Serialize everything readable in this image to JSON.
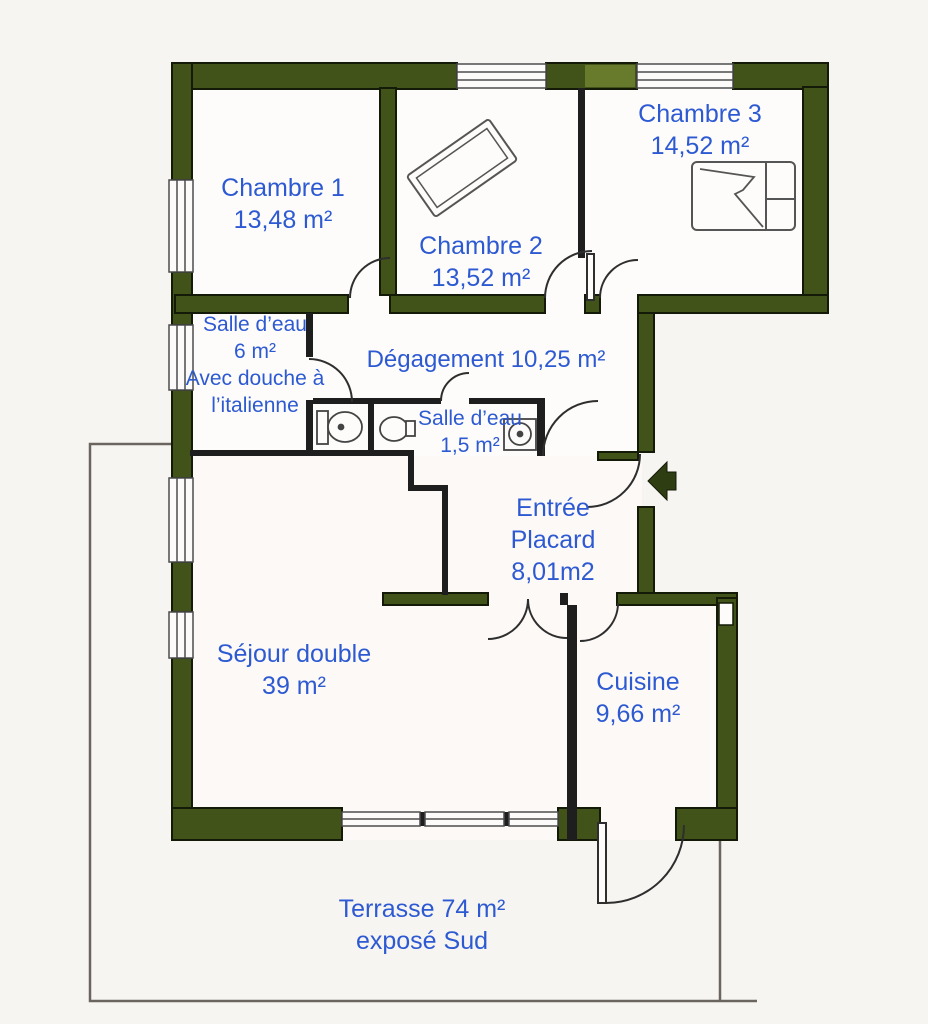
{
  "document": {
    "type": "apartment-floor-plan",
    "language": "fr"
  },
  "colors": {
    "label_blue": "#2d5ad2",
    "wall_green": "#42531a",
    "wall_highlight_green": "#6e8130",
    "background": "#f7f5f2"
  },
  "rooms": {
    "chambre1": {
      "name": "Chambre 1",
      "area": "13,48 m²"
    },
    "chambre2": {
      "name": "Chambre 2",
      "area": "13,52 m²"
    },
    "chambre3": {
      "name": "Chambre 3",
      "area": "14,52 m²"
    },
    "salle_eau_6": {
      "name": "Salle d’eau",
      "area": "6 m²",
      "note1": "Avec douche à",
      "note2": "l’italienne"
    },
    "degagement": {
      "label": "Dégagement 10,25 m²"
    },
    "salle_eau_15": {
      "name": "Salle d’eau",
      "area": "1,5 m²"
    },
    "entree": {
      "name": "Entrée",
      "name2": "Placard",
      "area": "8,01m2"
    },
    "sejour": {
      "name": "Séjour double",
      "area": "39 m²"
    },
    "cuisine": {
      "name": "Cuisine",
      "area": "9,66 m²"
    },
    "terrasse": {
      "name": "Terrasse 74 m²",
      "note": "exposé Sud"
    }
  },
  "icons": [
    "entrance-arrow-icon",
    "toilet-icon",
    "toilet-icon-2",
    "sink-icon",
    "bed-icon",
    "rug-icon",
    "window-icon",
    "door-arc-icon"
  ]
}
